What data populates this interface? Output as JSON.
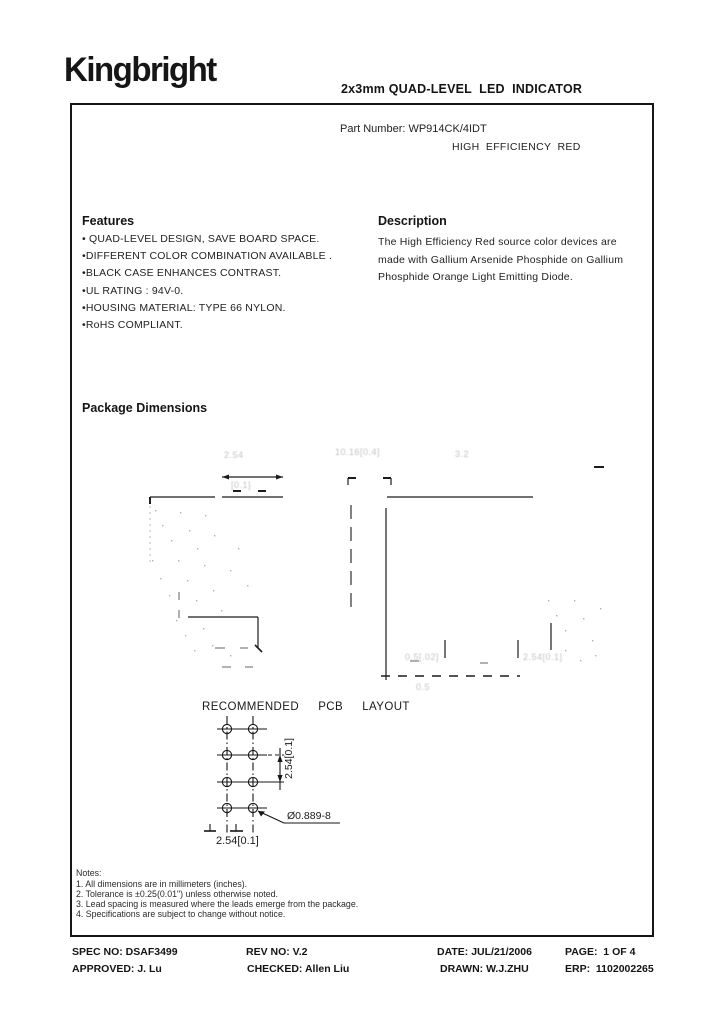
{
  "header": {
    "logo": "Kingbright",
    "doc_title": "2x3mm QUAD-LEVEL  LED  INDICATOR",
    "part_number": "Part Number: WP914CK/4IDT",
    "color_name": "HIGH  EFFICIENCY  RED"
  },
  "features": {
    "heading": "Features",
    "items": [
      "• QUAD-LEVEL DESIGN, SAVE BOARD SPACE.",
      "•DIFFERENT COLOR COMBINATION AVAILABLE .",
      "•BLACK CASE ENHANCES CONTRAST.",
      "•UL RATING : 94V-0.",
      "•HOUSING MATERIAL: TYPE 66 NYLON.",
      "•RoHS COMPLIANT."
    ]
  },
  "description": {
    "heading": "Description",
    "text": "The High Efficiency Red source color devices are made with Gallium Arsenide Phosphide on Gallium Phosphide Orange Light Emitting Diode."
  },
  "package": {
    "heading": "Package Dimensions",
    "pcb": {
      "title": "RECOMMENDED  PCB  LAYOUT",
      "dim_vertical": "2.54[0.1]",
      "dim_horizontal": "2.54[0.1]",
      "hole_callout": "Ø0.889-8"
    },
    "faint_labels": {
      "front_top_mm": "2.54",
      "front_top_in": "[0.1]",
      "side_top": "10.16[0.4]",
      "side_top_right": "3.2",
      "bottom_mid": "0.5[.02]",
      "bottom_right": "2.54[0.1]",
      "below_line": "0.5"
    }
  },
  "notes": {
    "heading": "Notes:",
    "items": [
      "1. All dimensions are in millimeters (inches).",
      "2. Tolerance is ±0.25(0.01\") unless otherwise noted.",
      "3. Lead spacing is measured where the leads emerge from the package.",
      "4. Specifications are subject to change without notice."
    ]
  },
  "footer": {
    "spec_no": "SPEC NO: DSAF3499",
    "rev_no": "REV NO: V.2",
    "date": "DATE: JUL/21/2006",
    "page": "PAGE:  1 OF 4",
    "approved": "APPROVED: J. Lu",
    "checked": "CHECKED: Allen Liu",
    "drawn": "DRAWN: W.J.ZHU",
    "erp": "ERP:  1102002265"
  }
}
